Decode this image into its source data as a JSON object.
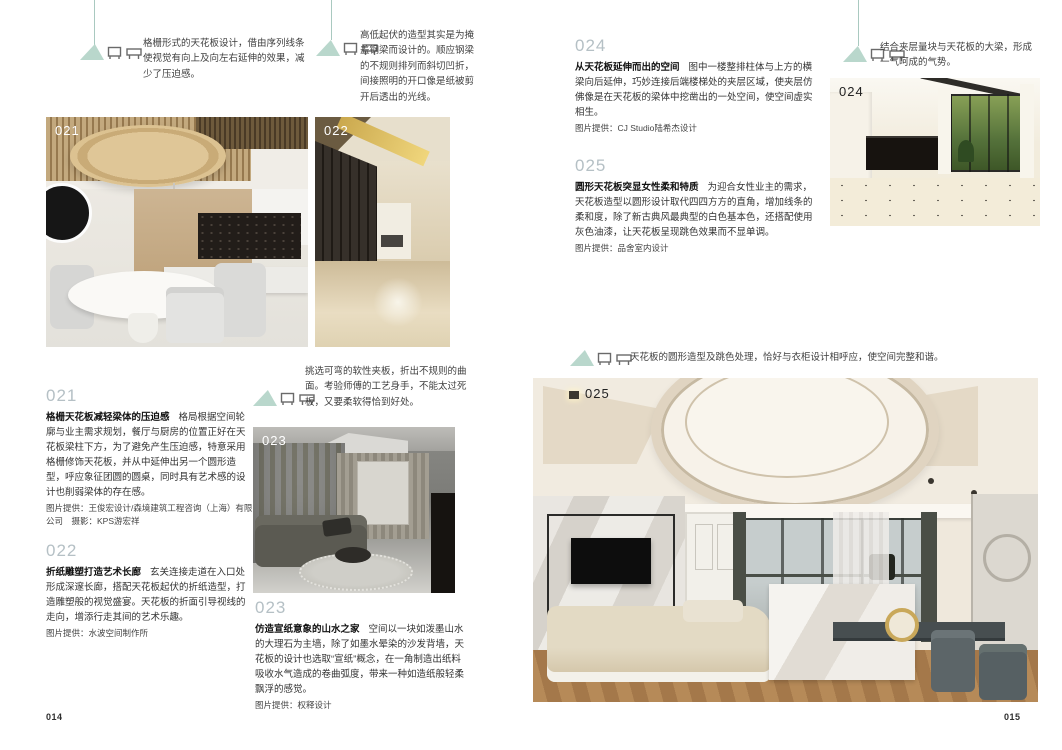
{
  "book": {
    "left_page_number": "014",
    "right_page_number": "015",
    "accent_color": "#b9d7cc",
    "number_color": "#b5c0c5",
    "icons": {
      "annotation_marker": "teal-triangle-lamp-marker",
      "marker_glyphs": [
        "wardrobe-icon",
        "table-icon"
      ]
    }
  },
  "page_left": {
    "annotations": [
      {
        "text": "格栅形式的天花板设计，借由序列线条使视觉有向上及向左右延伸的效果，减少了压迫感。"
      },
      {
        "text": "高低起伏的造型其实是为掩盖钢梁而设计的。顺应钢梁的不规则排列而斜切凹折，间接照明的开口像是纸被剪开后透出的光线。"
      },
      {
        "text": "挑选可弯的软性夹板，折出不规则的曲面。考验师傅的工艺身手，不能太过死板，又要柔软得恰到好处。"
      }
    ],
    "photos": [
      {
        "label": "021"
      },
      {
        "label": "022"
      },
      {
        "label": "023"
      }
    ],
    "entries": [
      {
        "number": "021",
        "title": "格栅天花板减轻梁体的压迫感",
        "body": "格局根据空间轮廓与业主需求规划，餐厅与厨房的位置正好在天花板梁柱下方，为了避免产生压迫感，特意采用格栅修饰天花板，并从中延伸出另一个圆形造型，呼应象征团圆的圆桌，同时具有艺术感的设计也削弱梁体的存在感。",
        "credit": "图片提供：王俊宏设计/森境建筑工程咨询（上海）有限公司　摄影：KPS游宏祥"
      },
      {
        "number": "022",
        "title": "折纸雕塑打造艺术长廊",
        "body": "玄关连接走道在入口处形成深邃长廊，搭配天花板起伏的折纸造型，打造雕塑般的视觉盛宴。天花板的折面引导视线的走向，增添行走其间的艺术乐趣。",
        "credit": "图片提供：水波空间制作所"
      },
      {
        "number": "023",
        "title": "仿造宣纸意象的山水之家",
        "body": "空间以一块如泼墨山水的大理石为主墙，除了如墨水晕染的沙发背墙，天花板的设计也选取“宣纸”概念，在一角制造出纸料吸收水气造成的卷曲弧度，带来一种如造纸般轻柔飘浮的感觉。",
        "credit": "图片提供：权释设计"
      }
    ]
  },
  "page_right": {
    "annotations": [
      {
        "text": "结合夹层量块与天花板的大梁，形成一气呵成的气势。"
      },
      {
        "text": "天花板的圆形造型及跳色处理，恰好与衣柜设计相呼应，使空间完整和谐。"
      }
    ],
    "photos": [
      {
        "label": "024"
      },
      {
        "label": "025"
      }
    ],
    "entries": [
      {
        "number": "024",
        "title": "从天花板延伸而出的空间",
        "body": "图中一楼整排柱体与上方的横梁向后延伸，巧妙连接后端楼梯处的夹层区域，使夹层仿佛像是在天花板的梁体中挖凿出的一处空间，使空间虚实相生。",
        "credit": "图片提供：CJ Studio陆希杰设计"
      },
      {
        "number": "025",
        "title": "圆形天花板突显女性柔和特质",
        "body": "为迎合女性业主的需求，天花板造型以圆形设计取代四四方方的直角，增加线条的柔和度，除了新古典风最典型的白色基本色，还搭配使用灰色油漆，让天花板呈现跳色效果而不显单调。",
        "credit": "图片提供：品舍室内设计"
      }
    ]
  }
}
